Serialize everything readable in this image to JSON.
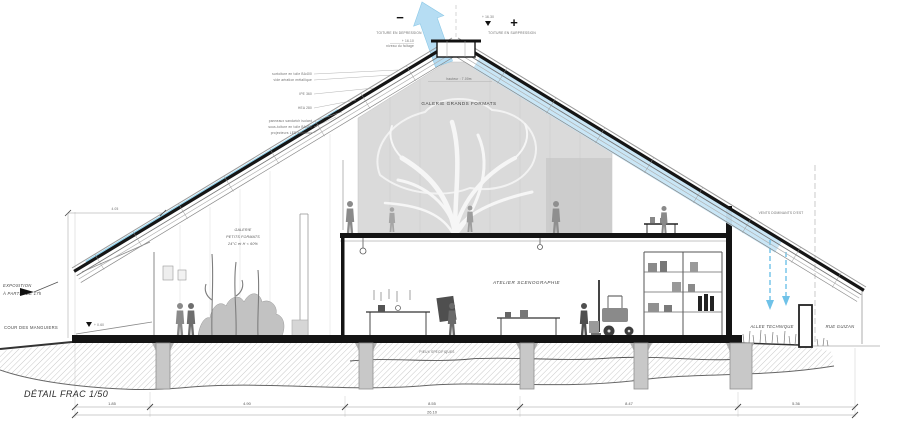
{
  "drawing": {
    "pressure_minus": "−",
    "pressure_plus": "+",
    "toiture_depression": "TOITURE EN DEPRESSION",
    "toiture_surpression": "TOITURE EN SURPRESSION",
    "ridge_level": "+ 16.30",
    "ridge_sublevel": "+ 16.10",
    "ridge_note": "niveau du faîtage",
    "roof_layers": [
      "surtoiture en toile BA400",
      "vide aération métallique",
      "IPE 360",
      "HEA 280",
      "panneaux sandwich isolant",
      "sous-toiture en toile BA400",
      "projecteurs LED lumineux"
    ],
    "hall_label": "GALERIE GRANDS FORMATS",
    "hall_height_note": "hauteur : 7.00m",
    "petits_line1": "GALERIE",
    "petits_line2": "PETITS FORMATS",
    "petits_line3": "24°C et H &lt; 60%",
    "atelier_label": "ATELIER SCENOGRAPHIE",
    "expo_line1": "EXPOSITION",
    "expo_line2": "À PARTIR DE 17h",
    "cour_label": "COUR DES MANGUIERS",
    "allee_label": "ALLEE TECHNIQUE",
    "rue_label": "RUE GUIZAN",
    "vents_label": "VENTS DOMINANTS D'EST",
    "pieux_label": "PIEUX SPECIFIQUES",
    "ground_level": "+ 0.60",
    "dim_405": "4.05",
    "detail_label": "DÉTAIL FRAC 1/50"
  },
  "dimensions": {
    "segments": [
      "1.85",
      "4.90",
      "8.55",
      "8.47",
      "5.36"
    ],
    "total": "26.10"
  },
  "colors": {
    "arrow_blue": "#b3dcf3",
    "band_blue": "#c6e5f6",
    "line_blue": "#82cdec",
    "dash_blue": "#6fc2e8",
    "ink": "#141414",
    "hall_grey": "#dadada"
  }
}
